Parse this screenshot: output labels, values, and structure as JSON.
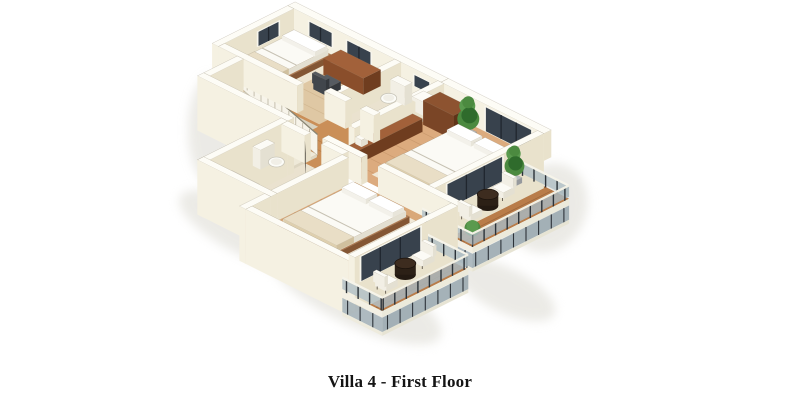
{
  "caption": {
    "text": "Villa 4 - First Floor"
  },
  "palette": {
    "background": "#ffffff",
    "wall_top": "#fdfcf6",
    "wall_lit": "#f5f1e2",
    "wall_shade": "#e9e2cc",
    "floor_hall": "#ca8f58",
    "floor_bedroom1": "#dfc8a4",
    "floor_master": "#dcab7e",
    "floor_bedroom3": "#d9a878",
    "floor_balcony": "#b97c49",
    "floor_bath": "#eae2cf",
    "rug": "#f0e7d5",
    "wood_dark": "#6f3d1f",
    "wood_mid": "#8a4e2b",
    "wood_light": "#a2613a",
    "bed_white": "#fbfaf5",
    "glass_window": "#38424d",
    "frame_dark": "#20262e",
    "railing_glass": "#b3c1c6",
    "railing_post": "#2c3238",
    "plant_green": "#4c8a40",
    "plant_dark": "#2f6b2c",
    "table_dark": "#3d2c1f",
    "shadow": "#dcdad2",
    "caption_color": "#141414"
  },
  "scene": {
    "type": "isometric-3d-floor-plan-render",
    "rooms": [
      "bedroom",
      "bathroom",
      "master-bedroom",
      "hallway",
      "staircase",
      "second-bathroom",
      "second-bedroom",
      "right-balcony",
      "bottom-balcony"
    ],
    "furniture": [
      "single-bed",
      "desk",
      "desk-chair",
      "toilet",
      "washbasin",
      "wardrobe",
      "potted-plant",
      "long-dresser",
      "double-bed",
      "second-double-bed",
      "bench-dresser",
      "shower-tray",
      "round-table",
      "outdoor-chairs",
      "balcony-plants"
    ],
    "features": [
      "wood-flooring",
      "glass-balcony-railing",
      "sliding-glass-doors",
      "dark-windows",
      "open-stair-railing",
      "white-cutaway-walls"
    ]
  }
}
